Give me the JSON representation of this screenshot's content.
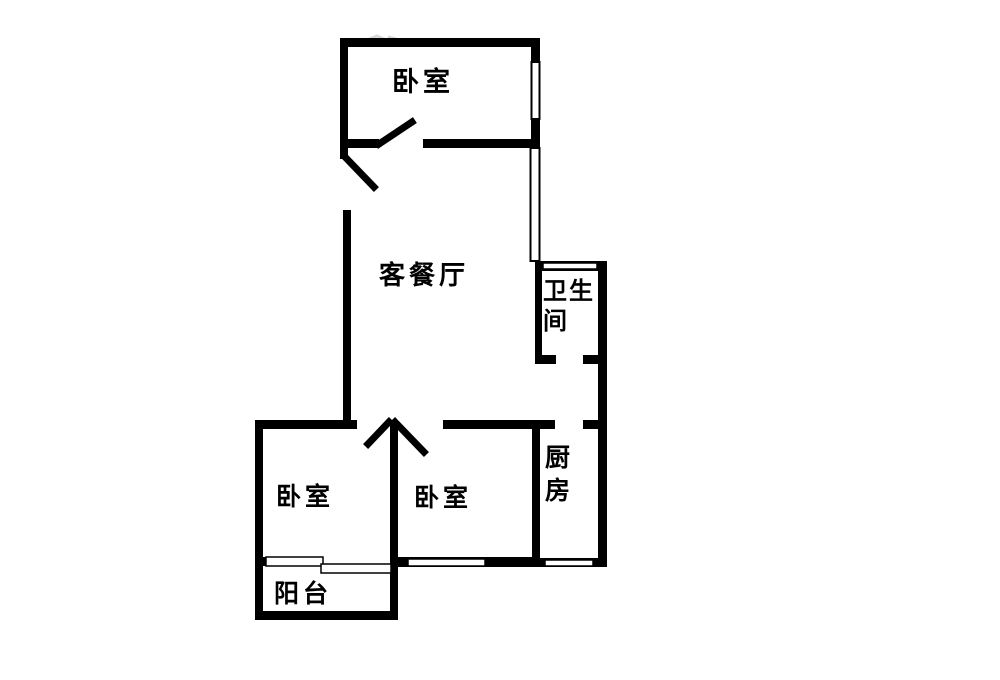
{
  "diagram": {
    "type": "floor-plan",
    "background_color": "#ffffff",
    "wall_color": "#000000",
    "text_color": "#000000"
  },
  "rooms": {
    "bedroom_top": {
      "label": "卧室"
    },
    "living_dining": {
      "label": "客餐厅"
    },
    "bathroom": {
      "label": "卫生间",
      "lines": [
        "卫生",
        "间"
      ]
    },
    "bedroom_left": {
      "label": "卧室"
    },
    "bedroom_middle": {
      "label": "卧室"
    },
    "kitchen": {
      "label": "厨房",
      "lines": [
        "厨",
        "房"
      ]
    },
    "balcony": {
      "label": "阳台"
    }
  }
}
